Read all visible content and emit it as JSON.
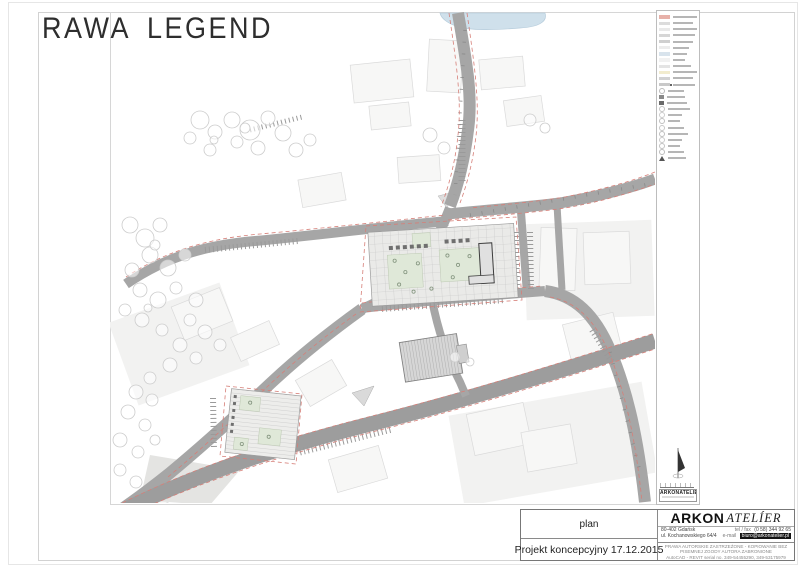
{
  "sheet": {
    "title_word1": "RAWA",
    "title_word2": "LEGEND"
  },
  "legend": {
    "mini_logo": "ARKONATELIER",
    "items": [
      {
        "kind": "swatch",
        "color": "#e7b1a9",
        "bar": 24
      },
      {
        "kind": "swatch",
        "color": "#dcdcdc",
        "bar": 20
      },
      {
        "kind": "swatch",
        "color": "#e9e9e9",
        "bar": 24
      },
      {
        "kind": "swatch",
        "color": "#d6d6d6",
        "bar": 22
      },
      {
        "kind": "swatch",
        "color": "#cfcfcf",
        "bar": 20
      },
      {
        "kind": "swatch",
        "color": "#ececec",
        "bar": 16
      },
      {
        "kind": "swatch",
        "color": "#d8e3ec",
        "bar": 14
      },
      {
        "kind": "swatch",
        "color": "#f1f1f1",
        "bar": 12
      },
      {
        "kind": "swatch",
        "color": "#e4e4e4",
        "bar": 18
      },
      {
        "kind": "swatch",
        "color": "#f2ecce",
        "bar": 24
      },
      {
        "kind": "swatch",
        "color": "#d2d2d2",
        "bar": 20
      },
      {
        "kind": "dot",
        "color": "#c9c9c9",
        "bar": 22
      },
      {
        "kind": "circle",
        "color": "#bbbbbb",
        "bar": 16
      },
      {
        "kind": "darksq",
        "color": "#8a8a8a",
        "bar": 18
      },
      {
        "kind": "darksq",
        "color": "#6b6b6b",
        "bar": 20
      },
      {
        "kind": "circle",
        "color": "#c4c4c4",
        "bar": 22
      },
      {
        "kind": "circle",
        "color": "#cccccc",
        "bar": 14
      },
      {
        "kind": "circle",
        "color": "#c0c0c0",
        "bar": 12
      },
      {
        "kind": "circle",
        "color": "#c8c8c8",
        "bar": 16
      },
      {
        "kind": "circle",
        "color": "#bfbfbf",
        "bar": 20
      },
      {
        "kind": "circle",
        "color": "#cacaca",
        "bar": 14
      },
      {
        "kind": "circle",
        "color": "#c2c2c2",
        "bar": 12
      },
      {
        "kind": "circle",
        "color": "#bdbdbd",
        "bar": 16
      },
      {
        "kind": "wedge",
        "color": "#555555",
        "bar": 18
      }
    ]
  },
  "titleblock": {
    "plan_label": "plan",
    "project_label": "Projekt koncepcyjny 17.12.2015",
    "brand_primary": "ARKON",
    "brand_secondary": "ATELÍER",
    "address_line1": "80-402 Gdańsk",
    "address_line2": "ul. Kochanowskiego 64/4",
    "tel_label": "tel / fax",
    "tel_value": "(0 58) 344 92 65",
    "email_label": "e-mail",
    "email_value": "biuro@arkonatelier.pl",
    "fineprint": [
      "PRAWA AUTORSKIE ZASTRZEŻONE - KOPIOWANIE BEZ PISEMNEJ ZGODY AUTORA ZABRONIONE",
      "AutoCAD - REVIT serial no. 349-54455290, 349-53175979",
      "AutoCAD LT serial no. 341-56560511, 341-56566429, 341-56568230"
    ]
  },
  "colors": {
    "road": "#a6a6a6",
    "accent_red": "#d67f78",
    "water": "#cfe0eb",
    "green": "#dfe8d8"
  }
}
